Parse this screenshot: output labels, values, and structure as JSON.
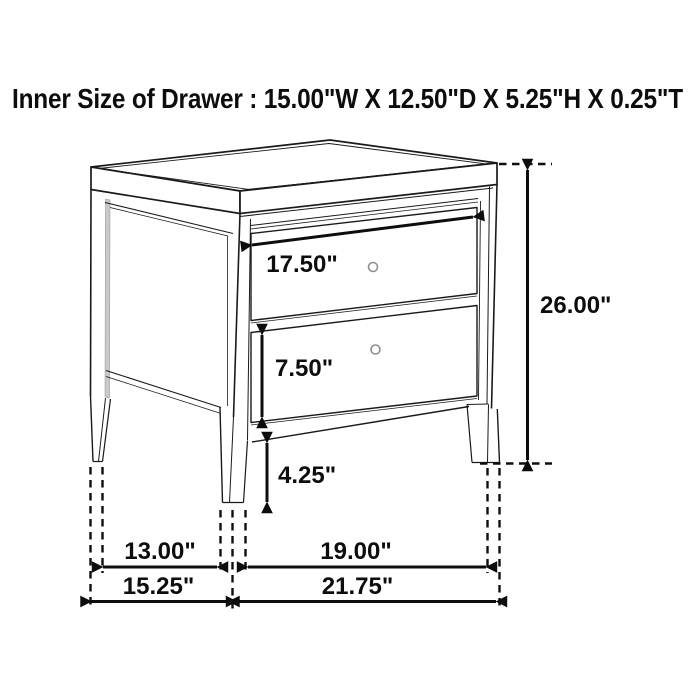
{
  "title": "Inner Size of Drawer : 15.00\"W X 12.50\"D X 5.25\"H X 0.25\"T",
  "diagram": {
    "kind": "furniture dimension line drawing",
    "item": "two-drawer nightstand, three-quarter isometric view",
    "drawer_count": 2
  },
  "dim_labels": {
    "drawer_width": "17.50\"",
    "overall_height": "26.00\"",
    "drawer_face_height": "7.50\"",
    "leg_height": "4.25\"",
    "inner_depth": "13.00\"",
    "overall_depth": "15.25\"",
    "inner_width": "19.00\"",
    "overall_width": "21.75\""
  },
  "colors": {
    "background": "#ffffff",
    "line": "#1a1a1a",
    "dimension": "#0d0d0d",
    "shading": "#c9c9c9"
  }
}
